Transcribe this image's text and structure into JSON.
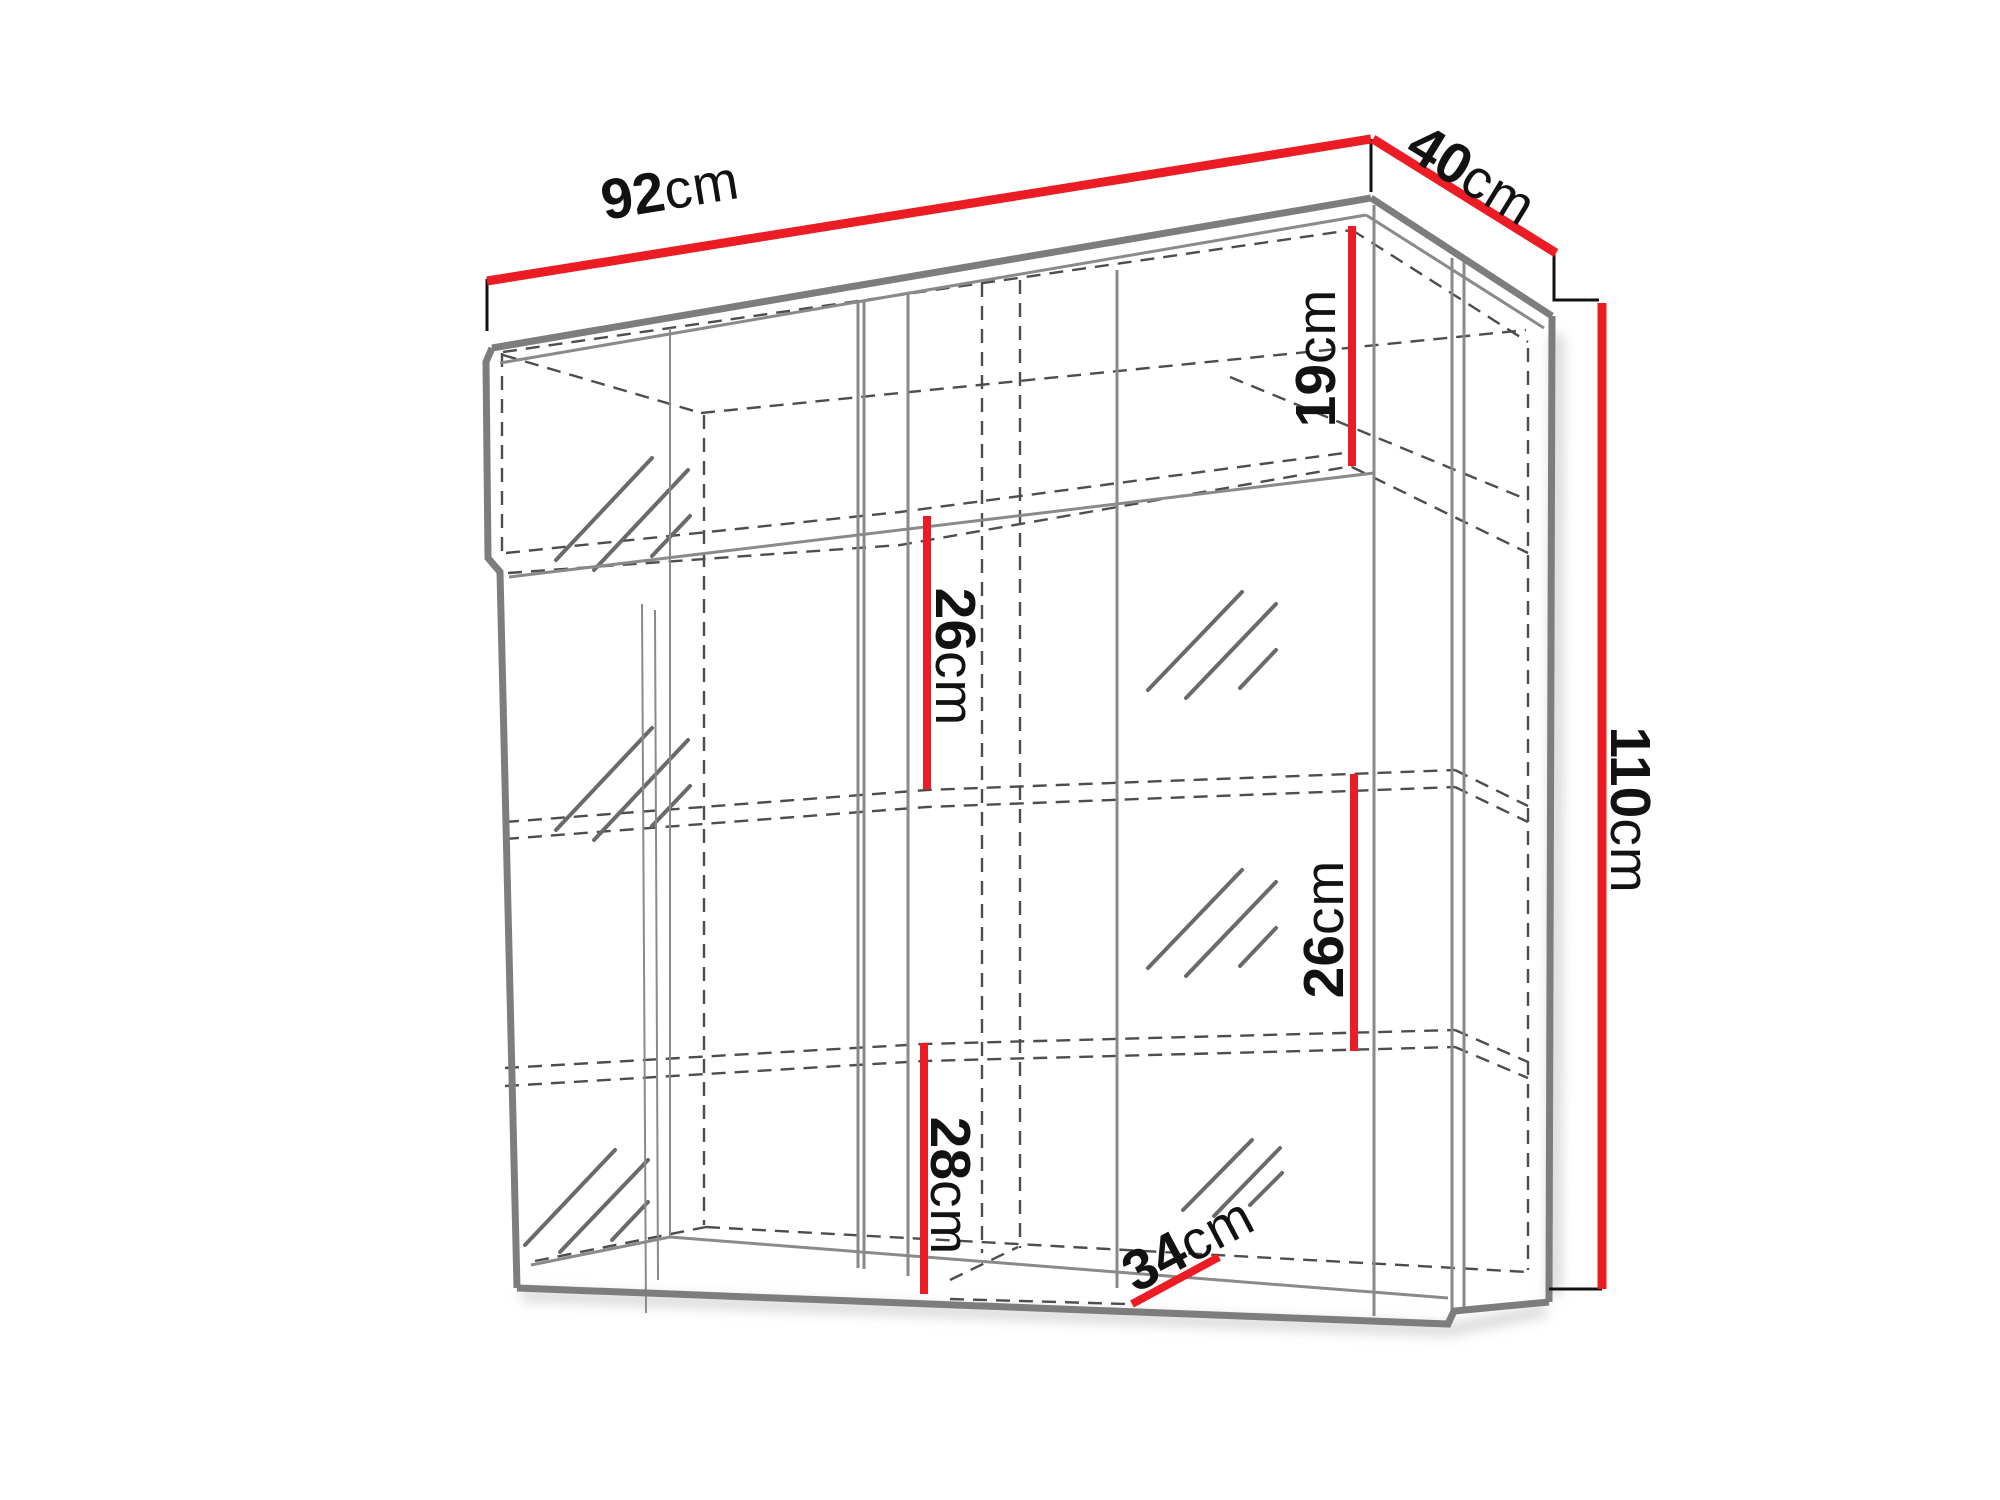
{
  "diagram": {
    "kind": "furniture dimension drawing",
    "subject": "wall display cabinet wireframe with glass doors"
  },
  "colors": {
    "dimension_red": "#ec1c24",
    "edge_gray": "#7d7d7d",
    "inner_gray": "#8a8a8a",
    "hidden_gray": "#4d4d4d",
    "glass_gray": "#6a6a6a",
    "label_black": "#121212",
    "background": "#ffffff"
  },
  "dimensions": {
    "top_width": {
      "value": "92",
      "unit": "cm"
    },
    "top_depth": {
      "value": "40",
      "unit": "cm"
    },
    "right_height": {
      "value": "110",
      "unit": "cm"
    },
    "upper_compartment_height": {
      "value": "19",
      "unit": "cm"
    },
    "left_shelf_gap": {
      "value": "26",
      "unit": "cm"
    },
    "right_shelf_gap": {
      "value": "26",
      "unit": "cm"
    },
    "bottom_shelf_gap": {
      "value": "28",
      "unit": "cm"
    },
    "interior_depth": {
      "value": "34",
      "unit": "cm"
    }
  }
}
